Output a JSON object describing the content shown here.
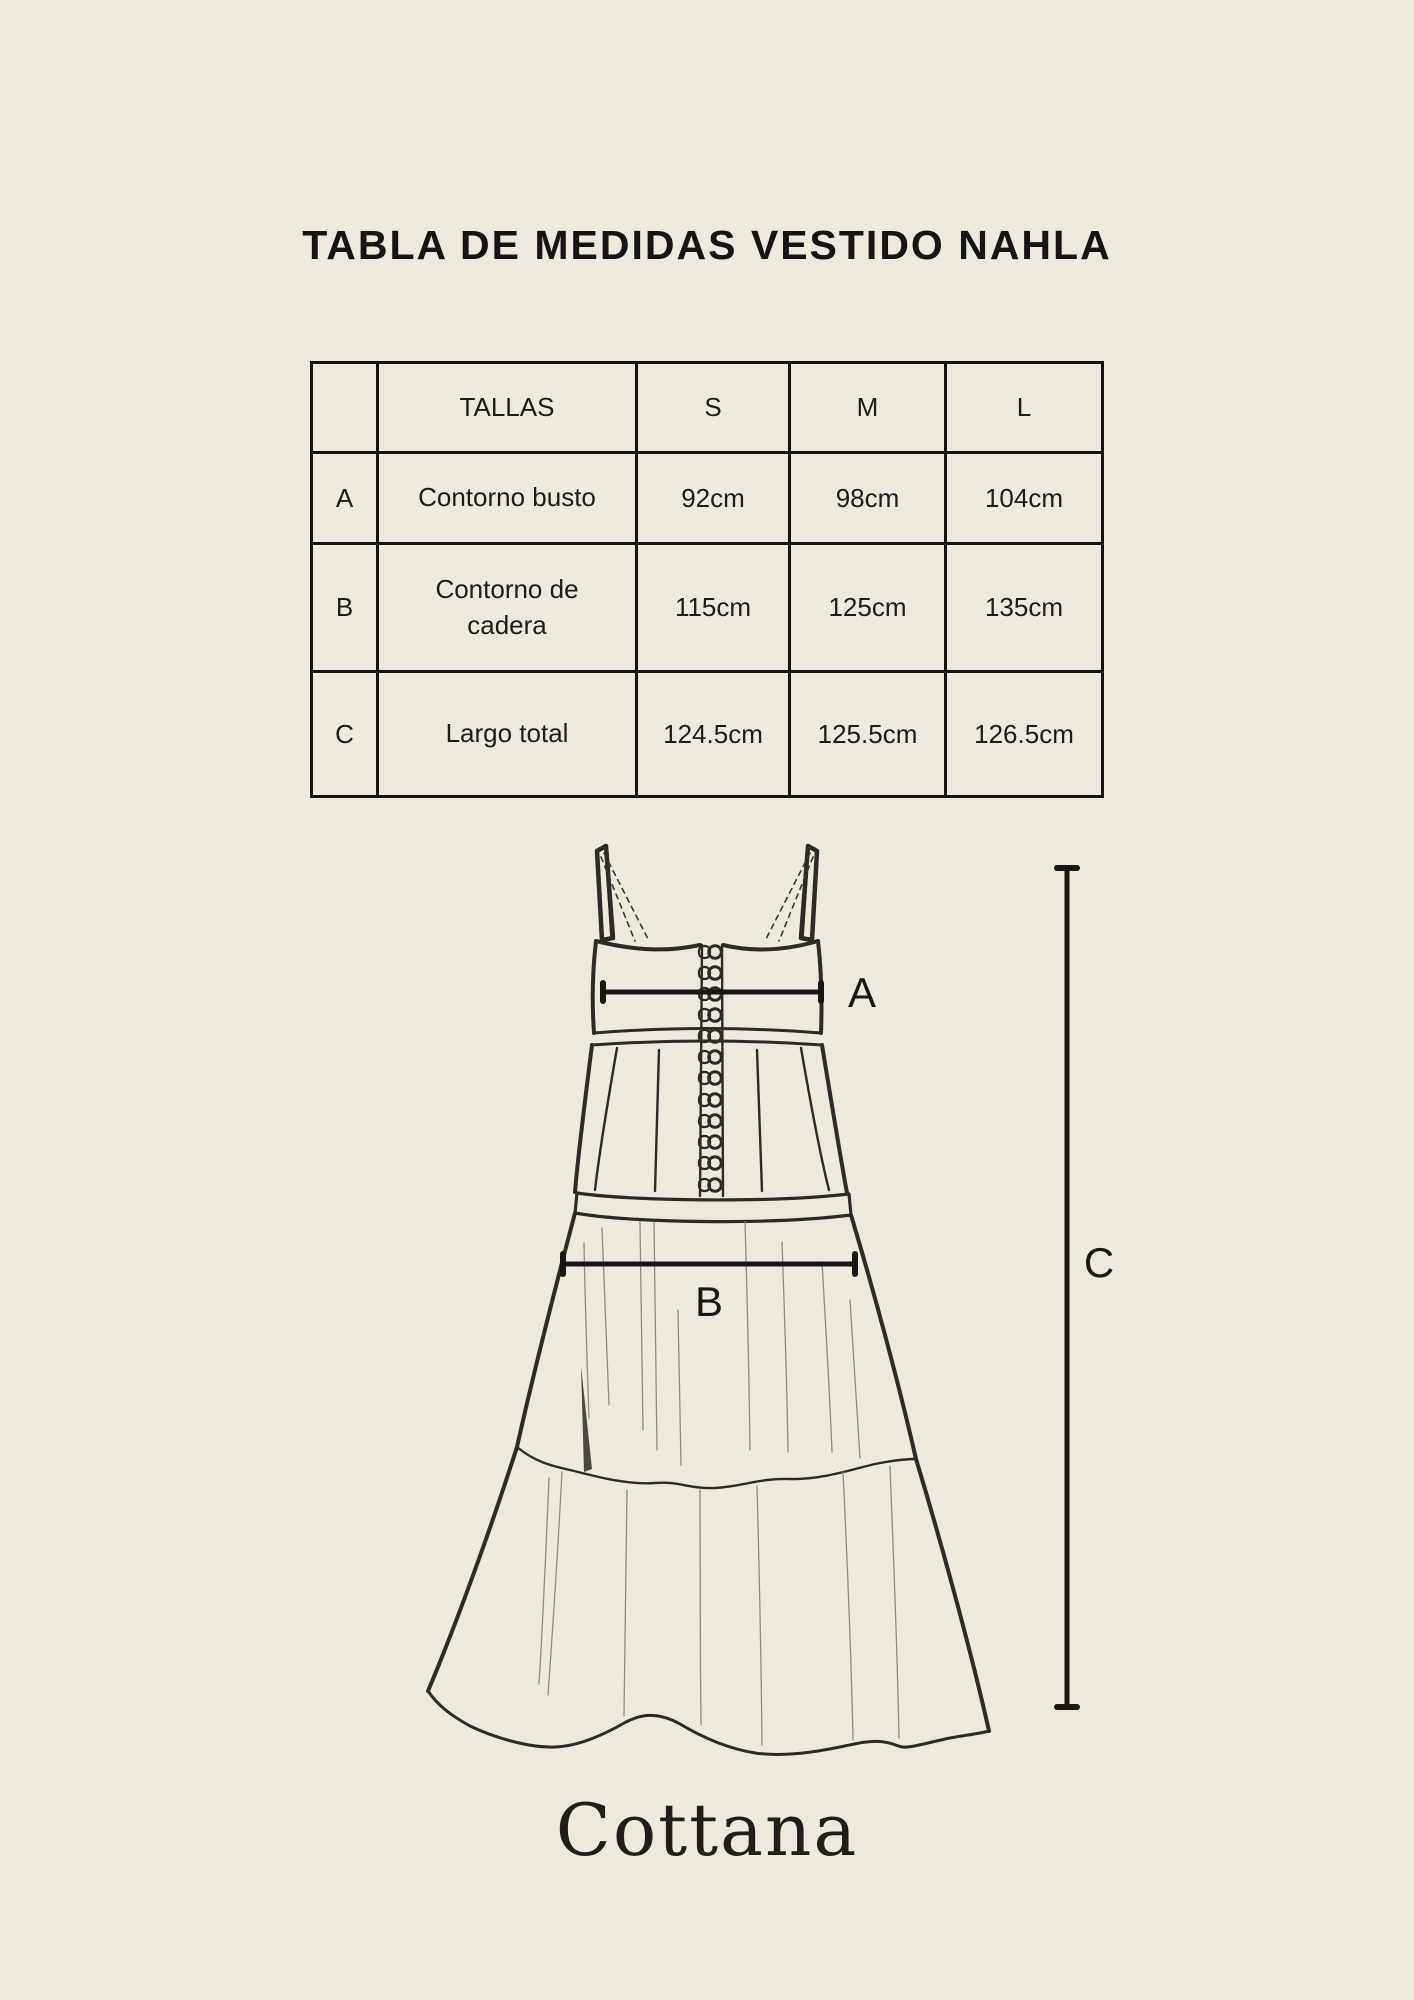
{
  "page": {
    "background_color": "#EDE9DD",
    "ink_color": "#1B1A17"
  },
  "title": "TABLA DE MEDIDAS VESTIDO NAHLA",
  "size_table": {
    "columns": [
      "",
      "TALLAS",
      "S",
      "M",
      "L"
    ],
    "rows": [
      {
        "key": "A",
        "label": "Contorno busto",
        "values": [
          "92cm",
          "98cm",
          "104cm"
        ]
      },
      {
        "key": "B",
        "label": "Contorno de cadera",
        "values": [
          "115cm",
          "125cm",
          "135cm"
        ]
      },
      {
        "key": "C",
        "label": "Largo total",
        "values": [
          "124.5cm",
          "125.5cm",
          "126.5cm"
        ]
      }
    ]
  },
  "diagram": {
    "labels": {
      "bust": "A",
      "hip": "B",
      "length": "C"
    },
    "line_color": "#2E2B26",
    "measure_color": "#181713"
  },
  "brand": {
    "logo_text": "Cottana"
  }
}
